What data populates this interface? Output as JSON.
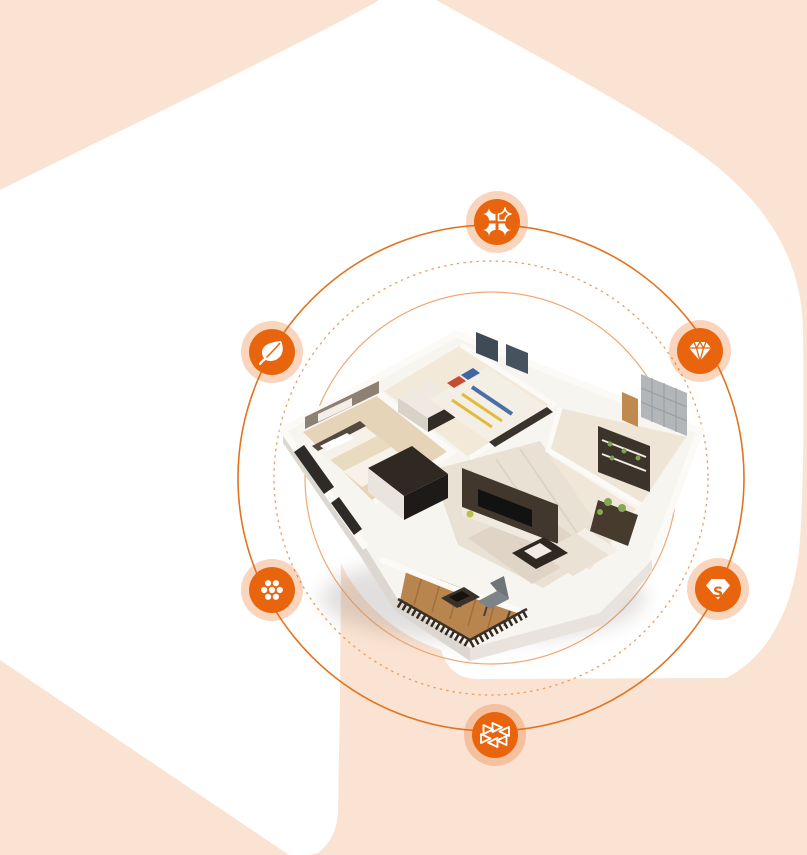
{
  "scene": {
    "kind": "interior-design-hero-graphic",
    "center_illustration": "isometric-3d-apartment-floorplan"
  },
  "colors": {
    "background_peach": "#fae3d2",
    "shape_white": "#ffffff",
    "orbit_solid": "#e2731f",
    "orbit_dashed": "#eb9e63",
    "orbit_inner": "#f0a873",
    "icon_orange": "#e8650e",
    "glyph_white": "#ffffff",
    "wood_floor": "#b9854e",
    "dark_furniture": "#42372c"
  },
  "orbits": {
    "outer_radius": 253,
    "dashed_radius": 217,
    "inner_radius": 186
  },
  "icons": [
    {
      "name": "petals-icon",
      "position": "top"
    },
    {
      "name": "gem-icon",
      "position": "right"
    },
    {
      "name": "leaf-icon",
      "position": "left"
    },
    {
      "name": "dots-cluster-icon",
      "position": "bottom-left"
    },
    {
      "name": "s-gem-icon",
      "position": "bottom-right",
      "letter": "S"
    },
    {
      "name": "triangle-ring-icon",
      "position": "bottom"
    }
  ]
}
